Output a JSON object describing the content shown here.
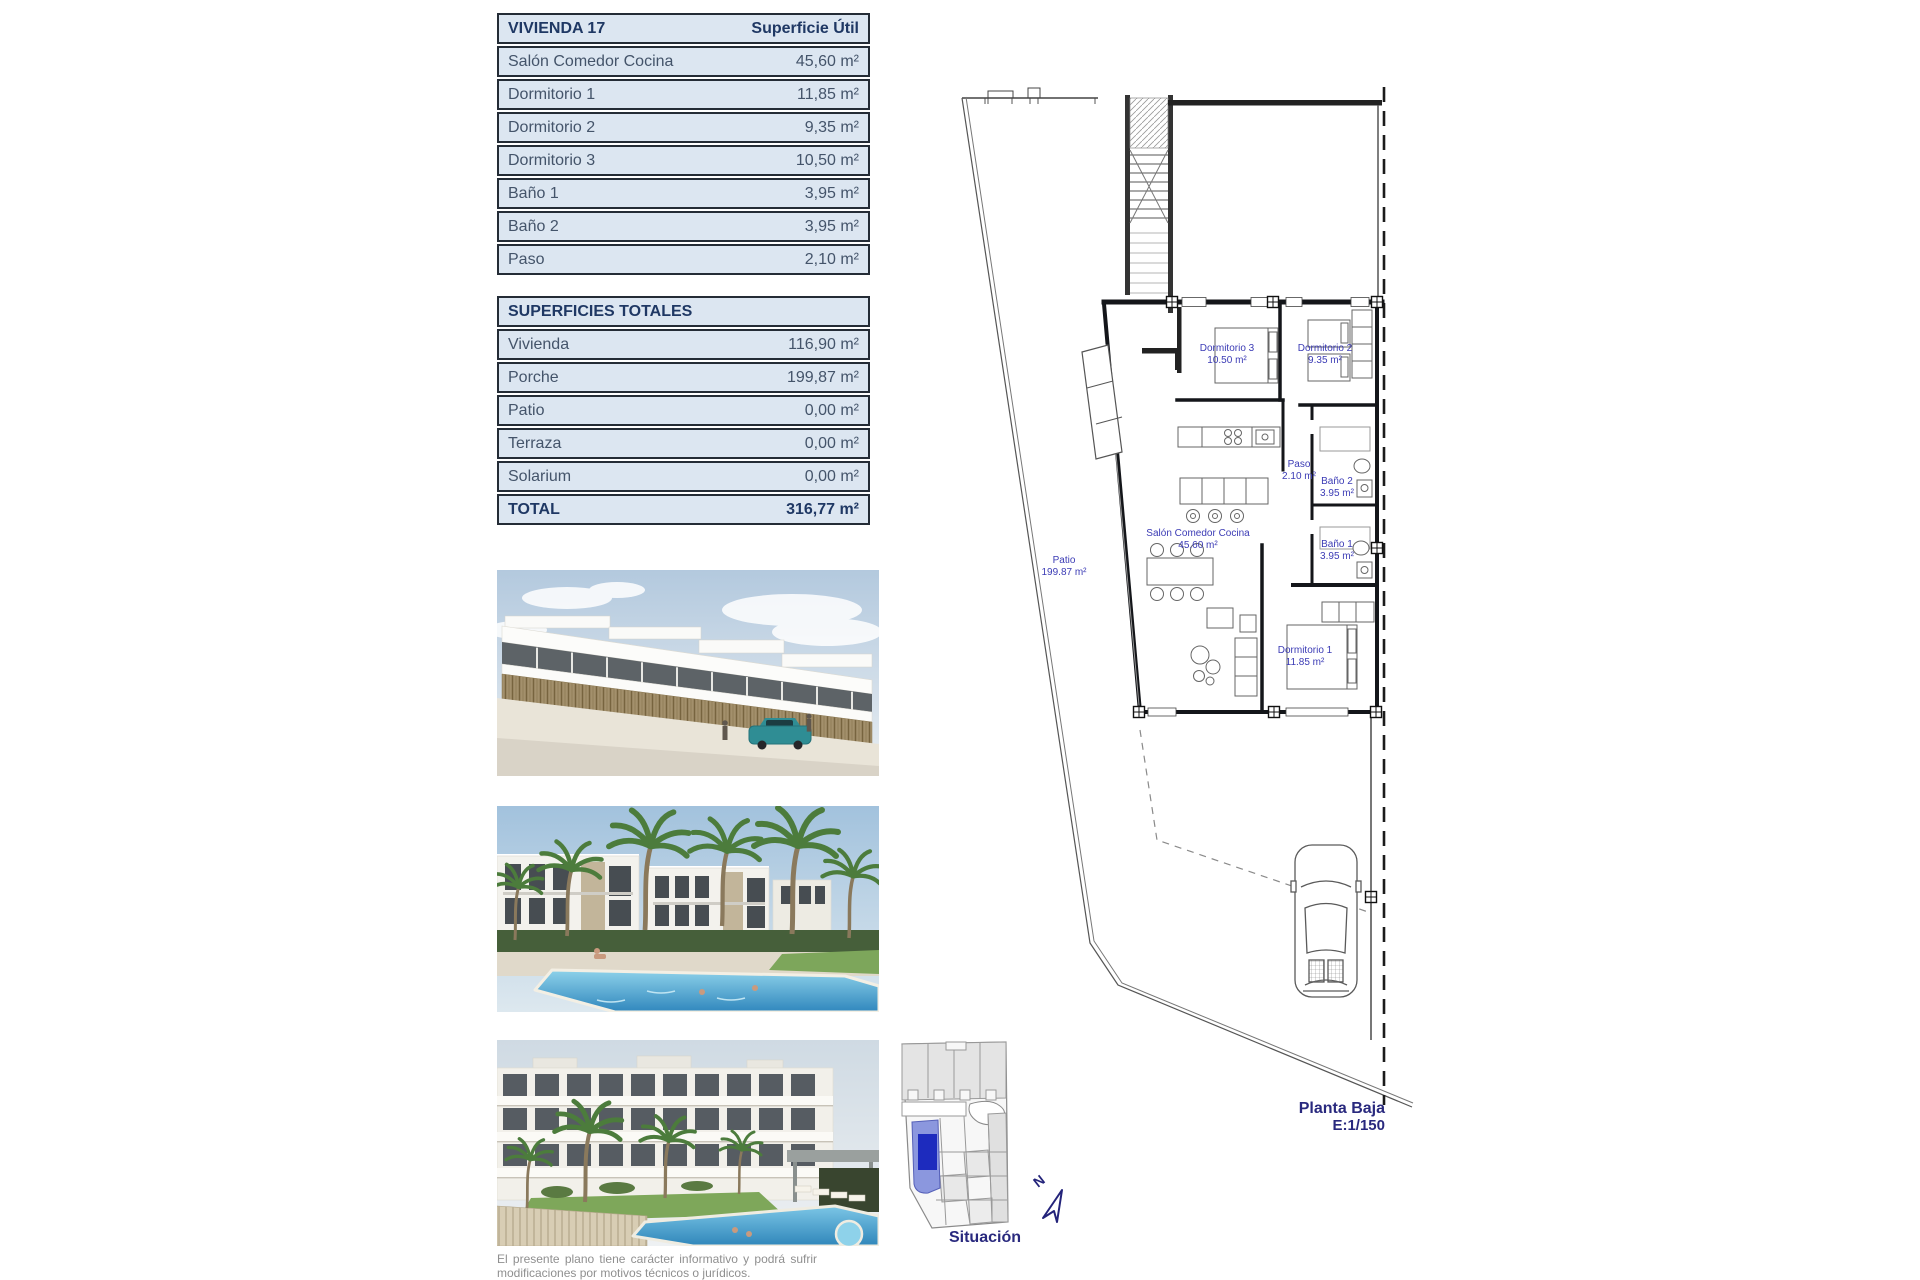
{
  "unit_table": {
    "title": "VIVIENDA 17",
    "column_header": "Superficie Útil",
    "rows": [
      {
        "label": "Salón Comedor Cocina",
        "value": "45,60 m²"
      },
      {
        "label": "Dormitorio 1",
        "value": "11,85 m²"
      },
      {
        "label": "Dormitorio 2",
        "value": "9,35 m²"
      },
      {
        "label": "Dormitorio 3",
        "value": "10,50 m²"
      },
      {
        "label": "Baño 1",
        "value": "3,95 m²"
      },
      {
        "label": "Baño 2",
        "value": "3,95 m²"
      },
      {
        "label": "Paso",
        "value": "2,10 m²"
      }
    ]
  },
  "totals_table": {
    "title": "SUPERFICIES TOTALES",
    "rows": [
      {
        "label": "Vivienda",
        "value": "116,90 m²"
      },
      {
        "label": "Porche",
        "value": "199,87 m²"
      },
      {
        "label": "Patio",
        "value": "0,00 m²"
      },
      {
        "label": "Terraza",
        "value": "0,00 m²"
      },
      {
        "label": "Solarium",
        "value": "0,00 m²"
      }
    ],
    "total": {
      "label": "TOTAL",
      "value": "316,77 m²"
    }
  },
  "floor_plan": {
    "labels": {
      "dormitorio3": {
        "name": "Dormitorio 3",
        "area": "10.50 m²"
      },
      "dormitorio2": {
        "name": "Dormitorio 2",
        "area": "9.35 m²"
      },
      "paso": {
        "name": "Paso",
        "area": "2.10 m²"
      },
      "bano2": {
        "name": "Baño 2",
        "area": "3.95 m²"
      },
      "bano1": {
        "name": "Baño 1",
        "area": "3.95 m²"
      },
      "salon": {
        "name": "Salón Comedor Cocina",
        "area": "45.60 m²"
      },
      "patio": {
        "name": "Patio",
        "area": "199.87 m²"
      },
      "dormitorio1": {
        "name": "Dormitorio 1",
        "area": "11.85 m²"
      }
    },
    "caption": {
      "line1": "Planta Baja",
      "line2": "E:1/150"
    }
  },
  "site_map": {
    "label": "Situación",
    "north_letter": "N"
  },
  "disclaimer": "El presente plano tiene carácter informativo y podrá sufrir modificaciones por motivos técnicos o jurídicos.",
  "photo_names": [
    "street-townhouses-render",
    "pool-courtyard-render",
    "apartments-pool-render"
  ],
  "colors": {
    "table_fill": "#dce6f1",
    "table_border": "#242c36",
    "table_text": "#44546a",
    "table_header_text": "#1f3864",
    "plan_label_blue": "#3b3bb5",
    "caption_navy": "#29297e",
    "parcel_highlight": "#1d2bbe",
    "parcel_light_blue": "#8b97de",
    "disclaimer_gray": "#8f8f8f"
  }
}
